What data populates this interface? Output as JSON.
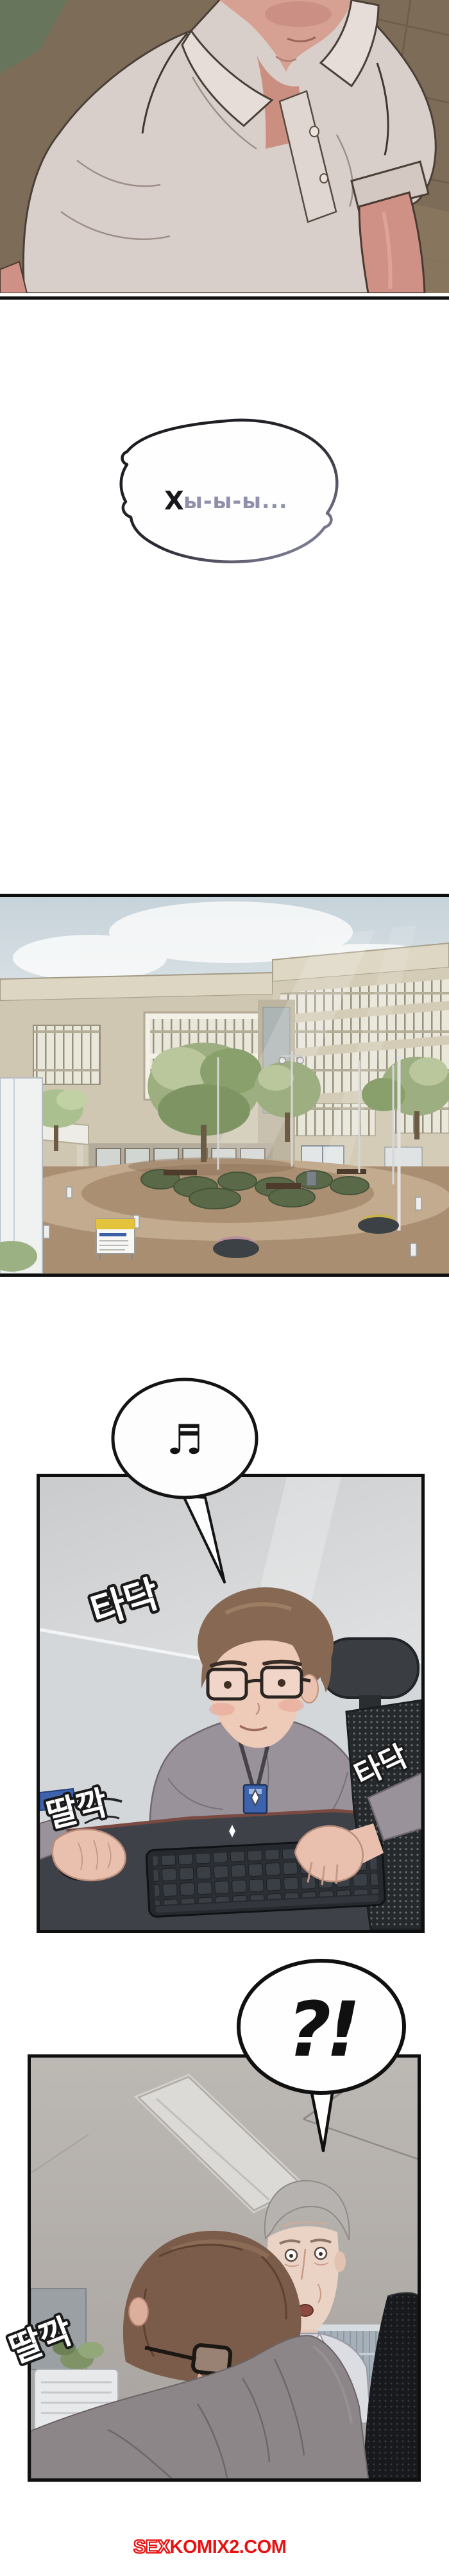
{
  "colors": {
    "page_bg": "#ffffff",
    "panel_border": "#0f0f0f",
    "bubble_fill": "#fdfdfd",
    "bubble_stroke": "#141414",
    "sfx_fill": "#fdfdfd",
    "sfx_outline": "#1a1a1a",
    "watermark_red": "#ea1111"
  },
  "bubble_sigh": {
    "initial": "Х",
    "rest": "ы-ы-ы...",
    "initial_color": "#17171c",
    "rest_color": "#8f90ab"
  },
  "bubble_music": {
    "icon": "music-note-icon",
    "glyph": "♬"
  },
  "bubble_surprise": {
    "text": "?!"
  },
  "panel3_sfx": {
    "typing_top": "타닥",
    "click_left": "딸깍",
    "typing_right": "타닥"
  },
  "panel4_sfx": {
    "click": "딸깍"
  },
  "watermark": {
    "outlined": "SEX",
    "solid": "KOMIX2.COM"
  }
}
